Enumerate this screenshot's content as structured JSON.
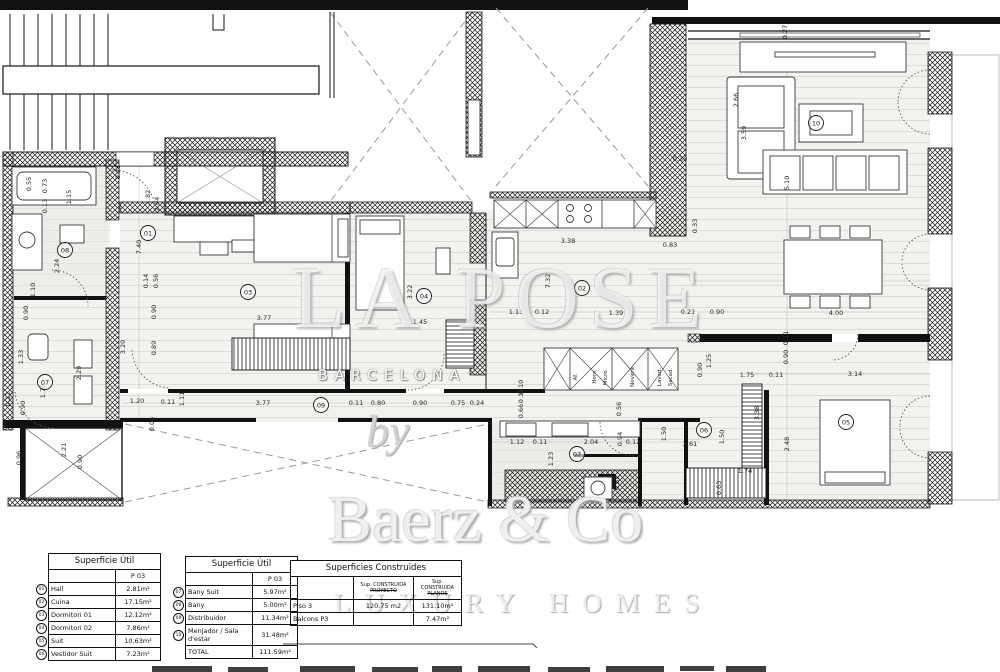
{
  "watermark": {
    "big": "LA POSE",
    "city": "BARCELONA",
    "by": "by",
    "brand": "Baerz & Co",
    "tagline": "LUXURY HOMES"
  },
  "tables": {
    "util1": {
      "title": "Superficie Útil",
      "col": "P 03",
      "rows": [
        {
          "num": "01",
          "name": "Hall",
          "area": "2.81m²"
        },
        {
          "num": "02",
          "name": "Cuina",
          "area": "17.15m²"
        },
        {
          "num": "03",
          "name": "Dormitori 01",
          "area": "12.12m²"
        },
        {
          "num": "04",
          "name": "Dormitori 02",
          "area": "7.86m²"
        },
        {
          "num": "05",
          "name": "Suit",
          "area": "10.63m²"
        },
        {
          "num": "06",
          "name": "Vestidor Suit",
          "area": "7.23m²"
        }
      ]
    },
    "util2": {
      "title": "Superficie Útil",
      "col": "P 03",
      "rows": [
        {
          "num": "07",
          "name": "Bany Suit",
          "area": "5.97m²"
        },
        {
          "num": "08",
          "name": "Bany",
          "area": "5.00m²"
        },
        {
          "num": "09",
          "name": "Distribuidor",
          "area": "11.34m²"
        },
        {
          "num": "10",
          "name": "Menjador / Sala d'estar",
          "area": "31.48m²"
        },
        {
          "num": "",
          "name": "TOTAL",
          "area": "111.59m²"
        }
      ]
    },
    "constr": {
      "title": "Superficies Construides",
      "col1a": "Sup. CONSTRUIDA",
      "col1b": "PROYECTO",
      "col2a": "Sup. CONSTRUIDA",
      "col2b": "PLANOS",
      "rows": [
        {
          "name": "Piso 3",
          "v1": "120.75 m2",
          "v2": "131.10m²"
        },
        {
          "name": "Balcons P3",
          "v1": "",
          "v2": "7.47m²"
        }
      ]
    }
  },
  "plan": {
    "room_markers": [
      {
        "n": "01",
        "x": 148,
        "y": 233
      },
      {
        "n": "02",
        "x": 582,
        "y": 288
      },
      {
        "n": "03",
        "x": 248,
        "y": 292
      },
      {
        "n": "04",
        "x": 424,
        "y": 296
      },
      {
        "n": "05",
        "x": 846,
        "y": 422
      },
      {
        "n": "06",
        "x": 704,
        "y": 430
      },
      {
        "n": "07",
        "x": 577,
        "y": 454
      },
      {
        "n": "07",
        "x": 45,
        "y": 382
      },
      {
        "n": "08",
        "x": 65,
        "y": 250
      },
      {
        "n": "09",
        "x": 321,
        "y": 405
      },
      {
        "n": "10",
        "x": 816,
        "y": 123
      }
    ],
    "fixture_labels": [
      {
        "t": "Af.",
        "x": 576,
        "y": 377
      },
      {
        "t": "Horn",
        "x": 595,
        "y": 377
      },
      {
        "t": "Micro.",
        "x": 606,
        "y": 377
      },
      {
        "t": "Nevera",
        "x": 633,
        "y": 377
      },
      {
        "t": "Lavad.",
        "x": 660,
        "y": 377
      },
      {
        "t": "Secad.",
        "x": 671,
        "y": 377
      }
    ],
    "dimension_labels": [
      {
        "t": "0.55",
        "x": 29,
        "y": 184,
        "r": -90
      },
      {
        "t": "0.73",
        "x": 45,
        "y": 186,
        "r": -90
      },
      {
        "t": "0.13",
        "x": 45,
        "y": 206,
        "r": -90
      },
      {
        "t": "1.15",
        "x": 69,
        "y": 197,
        "r": -90
      },
      {
        "t": "2.24",
        "x": 57,
        "y": 266,
        "r": -90
      },
      {
        "t": "1.10",
        "x": 33,
        "y": 290,
        "r": -90
      },
      {
        "t": "0.21",
        "x": 118,
        "y": 172,
        "r": -90
      },
      {
        "t": "1.82",
        "x": 148,
        "y": 197,
        "r": -90
      },
      {
        "t": "2.04",
        "x": 157,
        "y": 204,
        "r": -90
      },
      {
        "t": "7.40",
        "x": 139,
        "y": 247,
        "r": -90
      },
      {
        "t": "0.14",
        "x": 146,
        "y": 281,
        "r": -90
      },
      {
        "t": "0.56",
        "x": 156,
        "y": 281,
        "r": -90
      },
      {
        "t": "0.90",
        "x": 154,
        "y": 312,
        "r": -90
      },
      {
        "t": "0.90",
        "x": 26,
        "y": 313,
        "r": -90
      },
      {
        "t": "3.20",
        "x": 123,
        "y": 347,
        "r": -90
      },
      {
        "t": "0.89",
        "x": 154,
        "y": 348,
        "r": -90
      },
      {
        "t": "1.33",
        "x": 21,
        "y": 357,
        "r": -90
      },
      {
        "t": "2.29",
        "x": 79,
        "y": 373,
        "r": -90
      },
      {
        "t": "1.70",
        "x": 43,
        "y": 391,
        "r": -90
      },
      {
        "t": "0.90",
        "x": 23,
        "y": 408,
        "r": -90
      },
      {
        "t": "0.12",
        "x": 8,
        "y": 399,
        "r": -90
      },
      {
        "t": "2.21",
        "x": 64,
        "y": 450,
        "r": -90
      },
      {
        "t": "0.96",
        "x": 19,
        "y": 458,
        "r": -90
      },
      {
        "t": "0.90",
        "x": 80,
        "y": 462,
        "r": -90
      },
      {
        "t": "0.04",
        "x": 152,
        "y": 424,
        "r": -90
      },
      {
        "t": "1.20",
        "x": 137,
        "y": 401,
        "r": 0
      },
      {
        "t": "0.11",
        "x": 168,
        "y": 402,
        "r": 0
      },
      {
        "t": "1.11",
        "x": 182,
        "y": 399,
        "r": -90
      },
      {
        "t": "3.77",
        "x": 263,
        "y": 403,
        "r": 0
      },
      {
        "t": "0.11",
        "x": 356,
        "y": 403,
        "r": 0
      },
      {
        "t": "0.80",
        "x": 378,
        "y": 403,
        "r": 0
      },
      {
        "t": "0.90",
        "x": 420,
        "y": 403,
        "r": 0
      },
      {
        "t": "0.75",
        "x": 458,
        "y": 403,
        "r": 0
      },
      {
        "t": "0.24",
        "x": 477,
        "y": 403,
        "r": 0
      },
      {
        "t": "3.77",
        "x": 264,
        "y": 318,
        "r": 0
      },
      {
        "t": "3.22",
        "x": 410,
        "y": 292,
        "r": -90
      },
      {
        "t": "1.45",
        "x": 420,
        "y": 322,
        "r": 0
      },
      {
        "t": "3.38",
        "x": 568,
        "y": 241,
        "r": 0
      },
      {
        "t": "0.83",
        "x": 670,
        "y": 245,
        "r": 0
      },
      {
        "t": "7.32",
        "x": 548,
        "y": 281,
        "r": -90
      },
      {
        "t": "1.13",
        "x": 516,
        "y": 312,
        "r": 0
      },
      {
        "t": "0.12",
        "x": 542,
        "y": 312,
        "r": 0
      },
      {
        "t": "1.39",
        "x": 616,
        "y": 313,
        "r": 0
      },
      {
        "t": "0.21",
        "x": 688,
        "y": 312,
        "r": 0
      },
      {
        "t": "0.90",
        "x": 717,
        "y": 312,
        "r": 0
      },
      {
        "t": "4.00",
        "x": 836,
        "y": 313,
        "r": 0
      },
      {
        "t": "2.66",
        "x": 736,
        "y": 100,
        "r": -90
      },
      {
        "t": "3.59",
        "x": 744,
        "y": 133,
        "r": -90
      },
      {
        "t": "0.30",
        "x": 680,
        "y": 159,
        "r": 0
      },
      {
        "t": "0.33",
        "x": 695,
        "y": 226,
        "r": -90
      },
      {
        "t": "5.10",
        "x": 787,
        "y": 183,
        "r": -90
      },
      {
        "t": "0.27",
        "x": 785,
        "y": 32,
        "r": -90
      },
      {
        "t": "1.75",
        "x": 747,
        "y": 375,
        "r": 0
      },
      {
        "t": "0.11",
        "x": 776,
        "y": 375,
        "r": 0
      },
      {
        "t": "3.14",
        "x": 855,
        "y": 374,
        "r": 0
      },
      {
        "t": "0.90",
        "x": 786,
        "y": 357,
        "r": -90
      },
      {
        "t": "0.11",
        "x": 786,
        "y": 338,
        "r": -90
      },
      {
        "t": "2.48",
        "x": 787,
        "y": 444,
        "r": -90
      },
      {
        "t": "1.50",
        "x": 664,
        "y": 434,
        "r": -90
      },
      {
        "t": "1.50",
        "x": 722,
        "y": 437,
        "r": -90
      },
      {
        "t": "2.61",
        "x": 690,
        "y": 444,
        "r": 0
      },
      {
        "t": "1.74",
        "x": 745,
        "y": 471,
        "r": 0
      },
      {
        "t": "3.38",
        "x": 757,
        "y": 413,
        "r": -90
      },
      {
        "t": "0.63",
        "x": 719,
        "y": 488,
        "r": -90
      },
      {
        "t": "1.25",
        "x": 709,
        "y": 361,
        "r": -90
      },
      {
        "t": "0.90",
        "x": 700,
        "y": 370,
        "r": -90
      },
      {
        "t": "1.12",
        "x": 517,
        "y": 442,
        "r": 0
      },
      {
        "t": "0.11",
        "x": 540,
        "y": 442,
        "r": 0
      },
      {
        "t": "2.04",
        "x": 591,
        "y": 442,
        "r": 0
      },
      {
        "t": "0.12",
        "x": 633,
        "y": 442,
        "r": 0
      },
      {
        "t": "0.94",
        "x": 620,
        "y": 439,
        "r": -90
      },
      {
        "t": "1.23",
        "x": 551,
        "y": 459,
        "r": -90
      },
      {
        "t": "0.62",
        "x": 617,
        "y": 483,
        "r": -90
      },
      {
        "t": "0.56",
        "x": 619,
        "y": 409,
        "r": -90
      },
      {
        "t": "0.10",
        "x": 521,
        "y": 387,
        "r": -90
      },
      {
        "t": "0.10",
        "x": 521,
        "y": 396,
        "r": -90
      },
      {
        "t": "0.66",
        "x": 521,
        "y": 411,
        "r": -90
      }
    ]
  }
}
